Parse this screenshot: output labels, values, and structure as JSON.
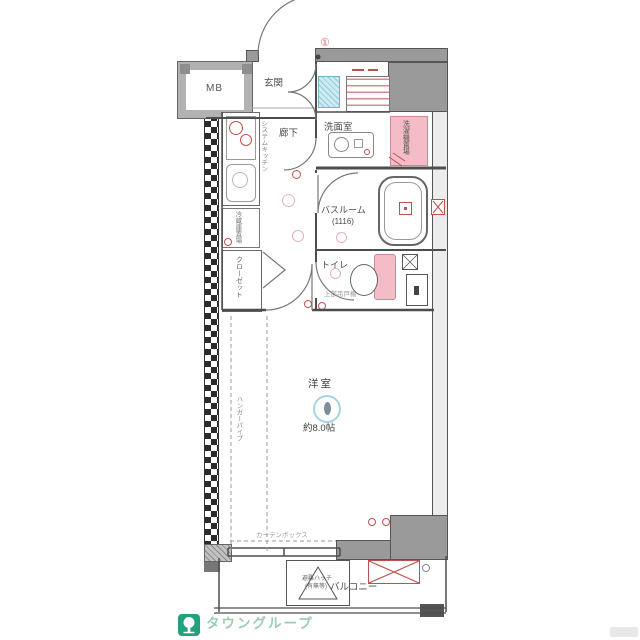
{
  "labels": {
    "mb": "MB",
    "entrance": "玄関",
    "hallway": "廊下",
    "washroom": "洗面室",
    "bathroom": "バスルーム",
    "bathroom_size": "(1116)",
    "toilet": "トイレ",
    "western_room": "洋室",
    "western_room_size": "約8.0帖",
    "balcony": "バルコニー",
    "closet": "クローゼット",
    "refrigerator": "冷蔵庫置場",
    "washer": "洗濯機置場",
    "kitchen": "システムキッチン",
    "curtain_box": "カーテンボックス",
    "hatch": "避難ハッチ",
    "hatch_note": "(有無等)",
    "upper_shelf": "上部吊戸棚",
    "hanger_pipe": "ハンガーパイプ",
    "mark_one": "①"
  },
  "branding": {
    "company": "タウングループ"
  },
  "colors": {
    "wall_gray": "#9a9a9a",
    "line_dark": "#4d4d4d",
    "accent_red": "#c0504d",
    "pink_fill": "#f4bcc6",
    "blue_fill": "#cde9f2",
    "light_blue_icon": "#a5d5e2",
    "logo_green": "#23a07e",
    "logo_text_green": "#9bcdb3"
  }
}
